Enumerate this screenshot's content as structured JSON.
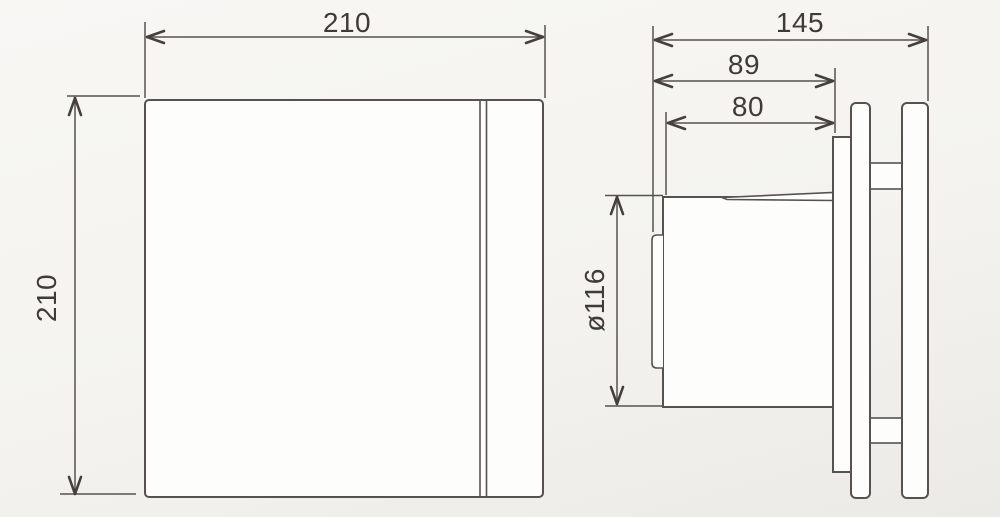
{
  "colors": {
    "paper": "#f4f3ef",
    "paper-light": "#f8f7f4",
    "paper-dark": "#eceae6",
    "shape-fill": "#fdfdfc",
    "line": "#57524d",
    "arrow": "#46403d",
    "text": "#403a39"
  },
  "front_view": {
    "width_dim": {
      "label": "210"
    },
    "height_dim": {
      "label": "210"
    }
  },
  "side_view": {
    "overall_depth_dim": {
      "label": "145"
    },
    "body_depth_dim": {
      "label": "89"
    },
    "spigot_depth_dim": {
      "label": "80"
    },
    "spigot_diameter_dim": {
      "label": "ø116"
    }
  }
}
